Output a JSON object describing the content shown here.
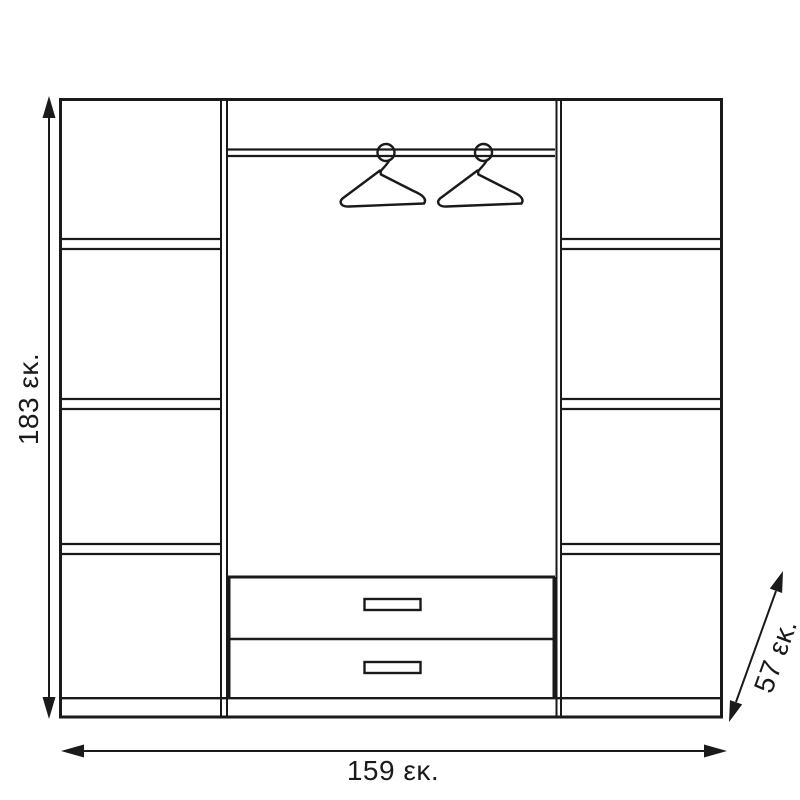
{
  "diagram": {
    "kind": "wardrobe-dimension-line-drawing",
    "colors": {
      "line": "#1a1a1a",
      "background": "#ffffff"
    },
    "labels": {
      "height": "183 εκ.",
      "width": "159 εκ.",
      "depth": "57 εκ."
    },
    "icons": [
      {
        "name": "hanger-icon",
        "count": 2
      }
    ],
    "features": {
      "left_shelf_compartments": 4,
      "right_shelf_compartments": 4,
      "drawers": 2,
      "drawer_handles": 2,
      "hanging_rod": true
    }
  }
}
